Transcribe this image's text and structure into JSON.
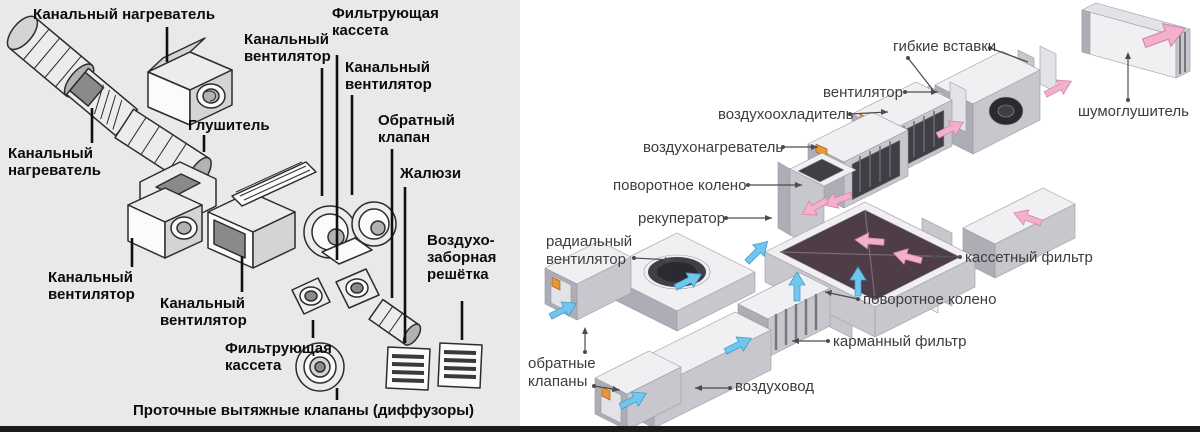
{
  "colors": {
    "left_background": "#e9e9e9",
    "right_background": "#ffffff",
    "bottom_bar": "#1b1b1b",
    "flow_supply_arrow": "#72c6ee",
    "flow_exhaust_arrow": "#f2b0cc",
    "fitting_orange": "#e8963c"
  },
  "left_diagram": {
    "labels": [
      {
        "id": "duct-heater-top",
        "text": "Канальный нагреватель"
      },
      {
        "id": "duct-fan-top-right",
        "text": "Канальный вентилятор"
      },
      {
        "id": "filter-cassette-top",
        "text": "Фильтрующая кассета"
      },
      {
        "id": "duct-fan-mid",
        "text": "Канальный вентилятор"
      },
      {
        "id": "check-valve",
        "text": "Обратный клапан"
      },
      {
        "id": "louvers",
        "text": "Жалюзи"
      },
      {
        "id": "silencer",
        "text": "Глушитель"
      },
      {
        "id": "duct-heater-left",
        "text": "Канальный нагреватель"
      },
      {
        "id": "duct-fan-bottom-left",
        "text": "Канальный вентилятор"
      },
      {
        "id": "duct-fan-bottom-mid",
        "text": "Канальный вентилятор"
      },
      {
        "id": "filter-cassette-bottom",
        "text": "Фильтрующая кассета"
      },
      {
        "id": "air-intake-grille",
        "text": "Воздухо-заборная решётка"
      },
      {
        "id": "caption",
        "text": "Проточные вытяжные клапаны (диффузоры)"
      }
    ]
  },
  "right_diagram": {
    "labels": [
      {
        "id": "flexible-inserts",
        "text": "гибкие вставки"
      },
      {
        "id": "fan",
        "text": "вентилятор"
      },
      {
        "id": "noise-silencer",
        "text": "шумоглушитель"
      },
      {
        "id": "air-cooler",
        "text": "воздухоохладитель"
      },
      {
        "id": "air-heater",
        "text": "воздухонагреватель"
      },
      {
        "id": "turn-elbow-supply",
        "text": "поворотное колено"
      },
      {
        "id": "recuperator",
        "text": "рекуператор"
      },
      {
        "id": "radial-fan",
        "text": "радиальный вентилятор"
      },
      {
        "id": "cassette-filter",
        "text": "кассетный фильтр"
      },
      {
        "id": "turn-elbow-return",
        "text": "поворотное колено"
      },
      {
        "id": "pocket-filter",
        "text": "карманный фильтр"
      },
      {
        "id": "check-valves",
        "text": "обратные клапаны"
      },
      {
        "id": "air-duct",
        "text": "воздуховод"
      }
    ]
  }
}
